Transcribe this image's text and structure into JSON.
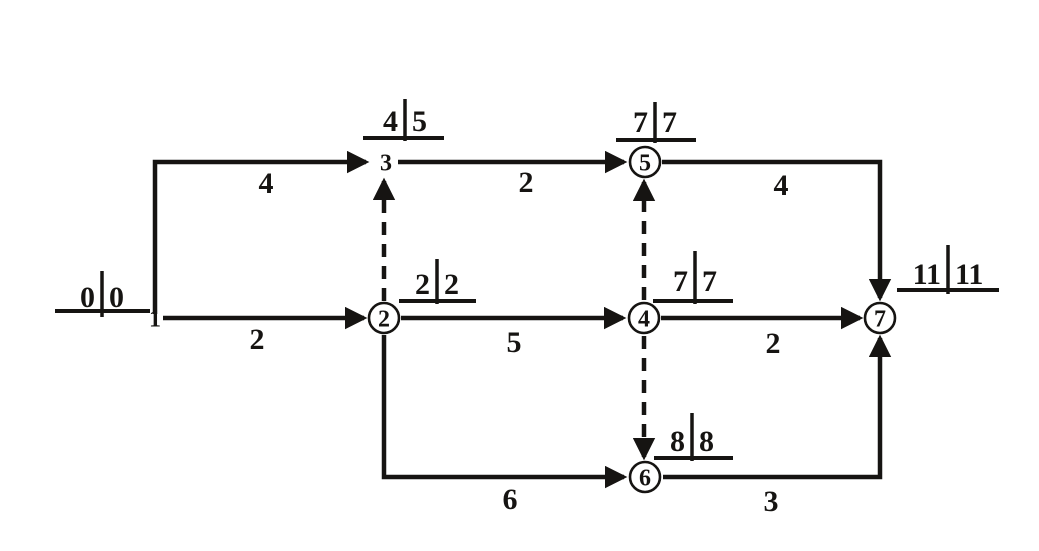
{
  "figure": {
    "kind": "activity-on-arrow network diagram (CPM)",
    "canvas": {
      "width": 1039,
      "height": 551,
      "background": "#ffffff",
      "ink": "#161412"
    },
    "style": {
      "edge_stroke_width": 4.5,
      "dash_pattern": "13 9",
      "node_radius": 15,
      "node_stroke_width": 2.6,
      "underline_stroke_width": 4,
      "bar_stroke_width": 3.5
    }
  },
  "nodes": [
    {
      "id": "1",
      "label": "1",
      "x": 155,
      "y": 318,
      "circle": false,
      "times": {
        "early": "0",
        "late": "0"
      },
      "time_label": {
        "bar_x": 102,
        "baseline_y": 307,
        "bar_y1": 271,
        "bar_y2": 317,
        "ul_x1": 55,
        "ul_x2": 150,
        "ul_y": 311
      }
    },
    {
      "id": "2",
      "label": "2",
      "x": 384,
      "y": 318,
      "circle": true,
      "times": {
        "early": "2",
        "late": "2"
      },
      "time_label": {
        "bar_x": 437,
        "baseline_y": 294,
        "bar_y1": 259,
        "bar_y2": 304,
        "ul_x1": 399,
        "ul_x2": 476,
        "ul_y": 301
      }
    },
    {
      "id": "3",
      "label": "3",
      "x": 386,
      "y": 162,
      "circle": false,
      "times": {
        "early": "4",
        "late": "5"
      },
      "time_label": {
        "bar_x": 405,
        "baseline_y": 131,
        "bar_y1": 99,
        "bar_y2": 141,
        "ul_x1": 363,
        "ul_x2": 444,
        "ul_y": 138
      }
    },
    {
      "id": "4",
      "label": "4",
      "x": 644,
      "y": 318,
      "circle": true,
      "times": {
        "early": "7",
        "late": "7"
      },
      "time_label": {
        "bar_x": 695,
        "baseline_y": 291,
        "bar_y1": 251,
        "bar_y2": 304,
        "ul_x1": 653,
        "ul_x2": 733,
        "ul_y": 301
      }
    },
    {
      "id": "5",
      "label": "5",
      "x": 645,
      "y": 162,
      "circle": true,
      "times": {
        "early": "7",
        "late": "7"
      },
      "time_label": {
        "bar_x": 655,
        "baseline_y": 132,
        "bar_y1": 102,
        "bar_y2": 143,
        "ul_x1": 616,
        "ul_x2": 696,
        "ul_y": 140
      }
    },
    {
      "id": "6",
      "label": "6",
      "x": 645,
      "y": 477,
      "circle": true,
      "times": {
        "early": "8",
        "late": "8"
      },
      "time_label": {
        "bar_x": 692,
        "baseline_y": 451,
        "bar_y1": 413,
        "bar_y2": 461,
        "ul_x1": 654,
        "ul_x2": 733,
        "ul_y": 458
      }
    },
    {
      "id": "7",
      "label": "7",
      "x": 880,
      "y": 318,
      "circle": true,
      "times": {
        "early": "11",
        "late": "11"
      },
      "time_label": {
        "bar_x": 948,
        "baseline_y": 284,
        "bar_y1": 245,
        "bar_y2": 294,
        "ul_x1": 897,
        "ul_x2": 999,
        "ul_y": 290
      }
    }
  ],
  "edges": [
    {
      "id": "1-3",
      "from": "1",
      "to": "3",
      "duration": "4",
      "style": "solid",
      "points": [
        [
          155,
          314
        ],
        [
          155,
          162
        ],
        [
          366,
          162
        ]
      ],
      "label": {
        "x": 266,
        "y": 193
      }
    },
    {
      "id": "1-2",
      "from": "1",
      "to": "2",
      "duration": "2",
      "style": "solid",
      "points": [
        [
          163,
          318
        ],
        [
          364,
          318
        ]
      ],
      "label": {
        "x": 257,
        "y": 349
      }
    },
    {
      "id": "2-3",
      "from": "2",
      "to": "3",
      "duration": "",
      "style": "dashed",
      "points": [
        [
          384,
          301
        ],
        [
          384,
          181
        ]
      ],
      "label": null
    },
    {
      "id": "3-5",
      "from": "3",
      "to": "5",
      "duration": "2",
      "style": "solid",
      "points": [
        [
          398,
          162
        ],
        [
          624,
          162
        ]
      ],
      "label": {
        "x": 526,
        "y": 192
      }
    },
    {
      "id": "5-7",
      "from": "5",
      "to": "7",
      "duration": "4",
      "style": "solid",
      "points": [
        [
          662,
          162
        ],
        [
          880,
          162
        ],
        [
          880,
          298
        ]
      ],
      "label": {
        "x": 781,
        "y": 195
      }
    },
    {
      "id": "2-4",
      "from": "2",
      "to": "4",
      "duration": "5",
      "style": "solid",
      "points": [
        [
          401,
          318
        ],
        [
          623,
          318
        ]
      ],
      "label": {
        "x": 514,
        "y": 352
      }
    },
    {
      "id": "4-5",
      "from": "4",
      "to": "5",
      "duration": "",
      "style": "dashed",
      "points": [
        [
          644,
          300
        ],
        [
          644,
          182
        ]
      ],
      "label": null
    },
    {
      "id": "4-7",
      "from": "4",
      "to": "7",
      "duration": "2",
      "style": "solid",
      "points": [
        [
          661,
          318
        ],
        [
          860,
          318
        ]
      ],
      "label": {
        "x": 773,
        "y": 353
      }
    },
    {
      "id": "4-6",
      "from": "4",
      "to": "6",
      "duration": "",
      "style": "dashed",
      "points": [
        [
          644,
          336
        ],
        [
          644,
          457
        ]
      ],
      "label": null
    },
    {
      "id": "2-6",
      "from": "2",
      "to": "6",
      "duration": "6",
      "style": "solid",
      "points": [
        [
          384,
          335
        ],
        [
          384,
          477
        ],
        [
          624,
          477
        ]
      ],
      "label": {
        "x": 510,
        "y": 509
      }
    },
    {
      "id": "6-7",
      "from": "6",
      "to": "7",
      "duration": "3",
      "style": "solid",
      "points": [
        [
          663,
          477
        ],
        [
          880,
          477
        ],
        [
          880,
          338
        ]
      ],
      "label": {
        "x": 771,
        "y": 511
      }
    }
  ]
}
